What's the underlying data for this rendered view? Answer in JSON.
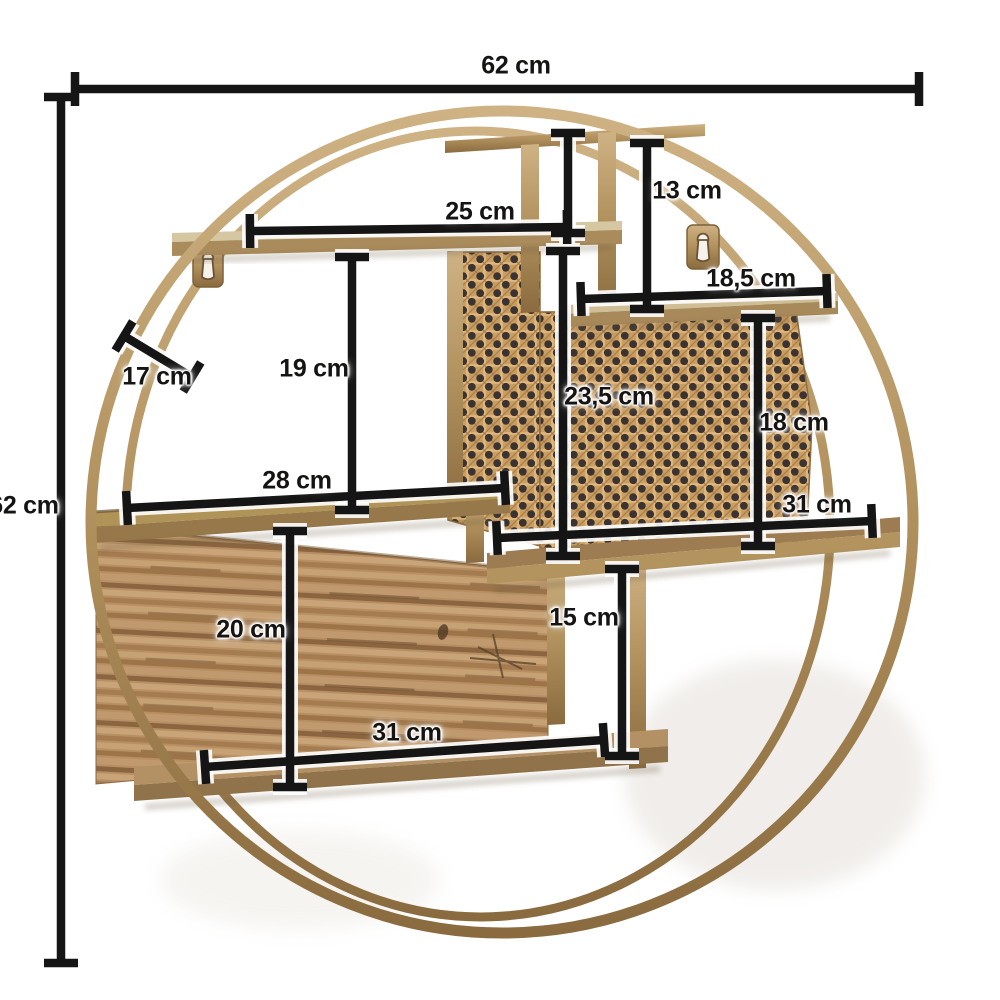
{
  "unit": "cm",
  "colors": {
    "dimension_line": "#151515",
    "frame_gold": "#b0905c",
    "frame_gold_light": "#cfb284",
    "frame_gold_dark": "#8a6b3f",
    "cane_webbing": "#c99e62",
    "cane_hole": "#3b3331",
    "wood_panel": "#b78f63",
    "background": "#ffffff"
  },
  "dimensions": [
    {
      "id": "overall-width",
      "label": "62 cm"
    },
    {
      "id": "overall-height",
      "label": "62 cm"
    },
    {
      "id": "top-shelf-width",
      "label": "25 cm"
    },
    {
      "id": "top-right-compartment-height",
      "label": "13 cm"
    },
    {
      "id": "upper-right-shelf-width",
      "label": "18,5 cm"
    },
    {
      "id": "frame-depth",
      "label": "17 cm"
    },
    {
      "id": "upper-left-compartment-height",
      "label": "19 cm"
    },
    {
      "id": "cane-panel-height",
      "label": "23,5 cm"
    },
    {
      "id": "right-compartment-height",
      "label": "18 cm"
    },
    {
      "id": "middle-shelf-width",
      "label": "28 cm"
    },
    {
      "id": "middle-right-shelf-width",
      "label": "31 cm"
    },
    {
      "id": "lower-left-compartment-height",
      "label": "20 cm"
    },
    {
      "id": "lower-right-compartment-height",
      "label": "15 cm"
    },
    {
      "id": "bottom-shelf-width",
      "label": "31 cm"
    }
  ]
}
